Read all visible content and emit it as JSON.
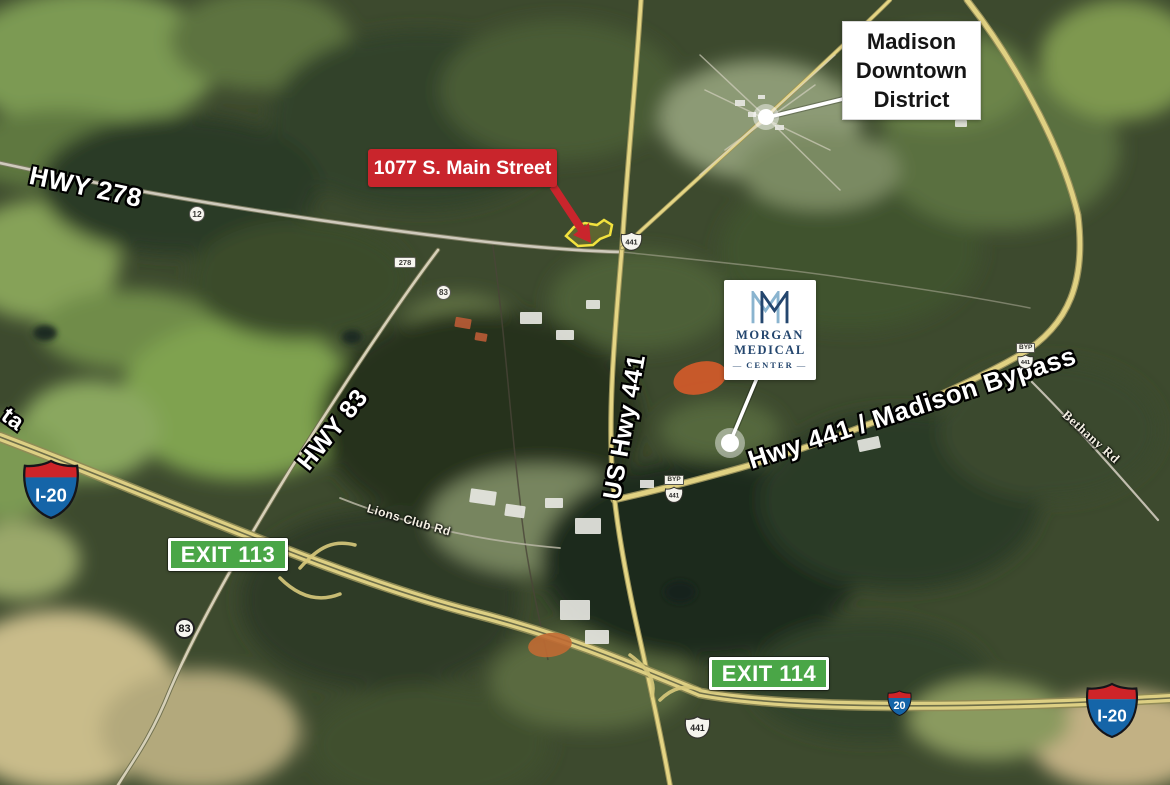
{
  "annotations": {
    "downtown_label": {
      "lines": [
        "Madison",
        "Downtown",
        "District"
      ]
    },
    "address_label": "1077 S. Main Street",
    "morgan_logo": {
      "line1": "MORGAN",
      "line2": "MEDICAL",
      "line3": "CENTER",
      "dash": "—"
    },
    "exit_badges": [
      {
        "label": "EXIT 113"
      },
      {
        "label": "EXIT 114"
      }
    ]
  },
  "road_labels": {
    "hwy278": "HWY 278",
    "hwy83": "HWY 83",
    "us_hwy441": "US Hwy 441",
    "madison_bypass": "Hwy 441 / Madison Bypass",
    "lions_club_rd": "Lions Club Rd",
    "bethany_rd": "Bethany Rd",
    "left_edge_partial": "ta"
  },
  "shields": {
    "i20_large_left": "I-20",
    "i20_large_right": "I-20",
    "i20_small": "20",
    "us441_main": "441",
    "us441_south": "441",
    "byp441_mid_banner": "BYP",
    "byp441_mid_number": "441",
    "byp441_east_banner": "BYP",
    "byp441_east_number": "441",
    "sr12": "12",
    "sr278": "278",
    "sr83_north": "83",
    "sr83_south": "83"
  },
  "colors": {
    "address_red": "#c9252c",
    "exit_green": "#4aa647",
    "interstate_blue": "#1565a8",
    "interstate_red": "#ce2428",
    "logo_navy": "#24466e",
    "logo_lightblue": "#8ab4cf",
    "parcel_yellow": "#f2e23e"
  }
}
